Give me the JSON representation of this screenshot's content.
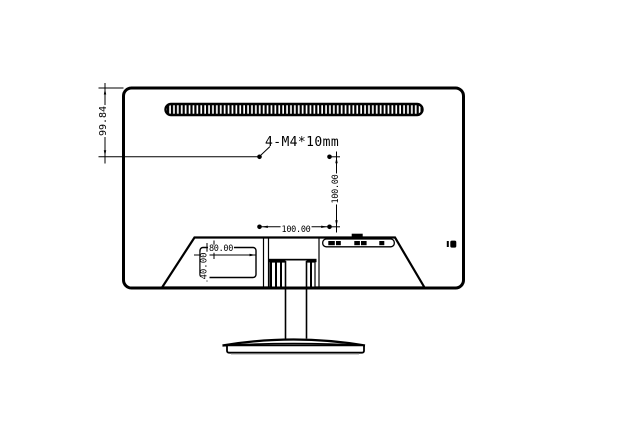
{
  "diagram": {
    "colors": {
      "line": "#000000",
      "background": "#ffffff",
      "shadow": "#b0b0b0"
    },
    "labels": {
      "screw_spec": "4-M4*10mm",
      "top_edge_to_vesa": "99.84",
      "vesa_vertical_pitch": "100.00",
      "vesa_horizontal_pitch": "100.00",
      "label_plate_width": "80.00",
      "label_plate_height": "40.00"
    }
  }
}
